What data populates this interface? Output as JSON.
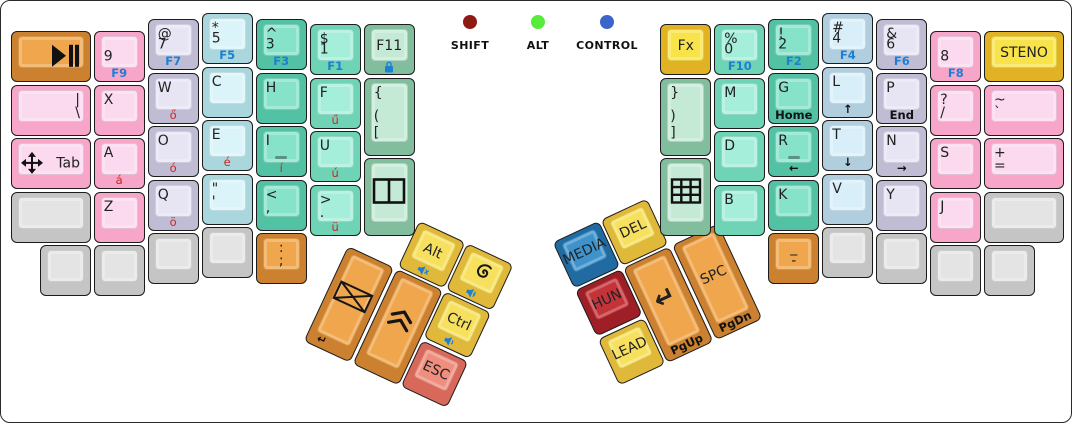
{
  "palette": {
    "canvas_bg": "#ffffff",
    "case_border": "#2a2a2a",
    "legend_blue": "#1b7fd4",
    "legend_red": "#cf2424",
    "colors": {
      "orange": {
        "base": "#cc8130",
        "face": "#efa64d"
      },
      "pink": {
        "base": "#f7a5c8",
        "face": "#fbd9ee"
      },
      "lavender": {
        "base": "#bfbcd3",
        "face": "#e7e5f4"
      },
      "cyan": {
        "base": "#aad7de",
        "face": "#daf4f9"
      },
      "teal": {
        "base": "#53c1a4",
        "face": "#86e3c9"
      },
      "green": {
        "base": "#6fd3b6",
        "face": "#a4eeda"
      },
      "sage": {
        "base": "#82bd9d",
        "face": "#c4ead5"
      },
      "lightblue": {
        "base": "#b1cede",
        "face": "#d8effa"
      },
      "yellow": {
        "base": "#e0b224",
        "face": "#f9e34a"
      },
      "yellowsoft": {
        "base": "#e0b93a",
        "face": "#f7e05e"
      },
      "blue": {
        "base": "#216ba3",
        "face": "#3f93cd"
      },
      "red": {
        "base": "#9e2026",
        "face": "#c43338"
      },
      "salmon": {
        "base": "#d7685a",
        "face": "#ef8e7e"
      },
      "gray": {
        "base": "#c5c5c5",
        "face": "#e4e4e4"
      }
    }
  },
  "indicators": [
    {
      "label": "SHIFT",
      "color": "#8e1a12",
      "cx": 469
    },
    {
      "label": "ALT",
      "color": "#57ec3a",
      "cx": 537
    },
    {
      "label": "CONTROL",
      "color": "#3b65cb",
      "cx": 606
    }
  ],
  "clusters": {
    "lt": {
      "x": 347,
      "y": 245,
      "angle": 25
    },
    "rt": {
      "x": 622,
      "y": 267,
      "angle": -25
    }
  },
  "keys": [
    {
      "name": "play-pause",
      "x": 10,
      "y": 30,
      "w": 80,
      "h": 51,
      "color": "orange",
      "icon_face": "play-pause-icon",
      "icon_pos": "ic-right",
      "legends": {}
    },
    {
      "name": "pipe-backslash",
      "x": 10,
      "y": 83.5,
      "w": 80,
      "h": 51,
      "color": "pink",
      "legends": {
        "tr": "|",
        "br": "\\"
      }
    },
    {
      "name": "tab",
      "x": 10,
      "y": 137,
      "w": 80,
      "h": 51,
      "color": "pink",
      "icon_face": "move-icon",
      "icon_pos": "ic-left",
      "legends": {
        "mr": "Tab"
      }
    },
    {
      "name": "blank-l1",
      "x": 10,
      "y": 190.5,
      "w": 80,
      "h": 51,
      "color": "gray",
      "legends": {}
    },
    {
      "name": "blank-l2",
      "x": 39,
      "y": 244,
      "w": 51,
      "h": 51,
      "color": "gray",
      "legends": {}
    },
    {
      "name": "9",
      "x": 92.7,
      "y": 30,
      "w": 51,
      "h": 51,
      "color": "pink",
      "legends": {
        "ml": "9",
        "front": "F9"
      },
      "front_color": "blue"
    },
    {
      "name": "x",
      "x": 92.7,
      "y": 83.5,
      "w": 51,
      "h": 51,
      "color": "pink",
      "legends": {
        "tl": "X"
      }
    },
    {
      "name": "a",
      "x": 92.7,
      "y": 137,
      "w": 51,
      "h": 51,
      "color": "pink",
      "legends": {
        "tl": "A",
        "front": "á"
      },
      "front_color": "red"
    },
    {
      "name": "z",
      "x": 92.7,
      "y": 190.5,
      "w": 51,
      "h": 51,
      "color": "pink",
      "legends": {
        "tl": "Z"
      }
    },
    {
      "name": "blank-l3",
      "x": 92.7,
      "y": 244,
      "w": 51,
      "h": 51,
      "color": "gray",
      "legends": {}
    },
    {
      "name": "7",
      "x": 146.7,
      "y": 18,
      "w": 51,
      "h": 51,
      "color": "lavender",
      "legends": {
        "tl": "@",
        "ml": "7",
        "front": "F7"
      },
      "front_color": "blue"
    },
    {
      "name": "w",
      "x": 146.7,
      "y": 71.5,
      "w": 51,
      "h": 51,
      "color": "lavender",
      "legends": {
        "tl": "W",
        "front": "ő"
      },
      "front_color": "red"
    },
    {
      "name": "o",
      "x": 146.7,
      "y": 125,
      "w": 51,
      "h": 51,
      "color": "lavender",
      "legends": {
        "tl": "O",
        "front": "ó"
      },
      "front_color": "red"
    },
    {
      "name": "q",
      "x": 146.7,
      "y": 178.5,
      "w": 51,
      "h": 51,
      "color": "lavender",
      "legends": {
        "tl": "Q",
        "front": "ö"
      },
      "front_color": "red"
    },
    {
      "name": "blank-l4",
      "x": 146.7,
      "y": 232,
      "w": 51,
      "h": 51,
      "color": "gray",
      "legends": {}
    },
    {
      "name": "5",
      "x": 200.7,
      "y": 12,
      "w": 51,
      "h": 51,
      "color": "cyan",
      "legends": {
        "tl": "*",
        "ml": "5",
        "front": "F5"
      },
      "front_color": "blue"
    },
    {
      "name": "c",
      "x": 200.7,
      "y": 65.5,
      "w": 51,
      "h": 51,
      "color": "cyan",
      "legends": {
        "tl": "C"
      }
    },
    {
      "name": "e",
      "x": 200.7,
      "y": 119,
      "w": 51,
      "h": 51,
      "color": "cyan",
      "legends": {
        "tl": "E",
        "front": "é"
      },
      "front_color": "red"
    },
    {
      "name": "quote-apostrophe",
      "x": 200.7,
      "y": 172.5,
      "w": 51,
      "h": 51,
      "color": "cyan",
      "legends": {
        "tl": "\"",
        "bl": "'"
      }
    },
    {
      "name": "blank-l5",
      "x": 200.7,
      "y": 226,
      "w": 51,
      "h": 51,
      "color": "gray",
      "legends": {}
    },
    {
      "name": "3",
      "x": 254.7,
      "y": 18,
      "w": 51,
      "h": 51,
      "color": "teal",
      "legends": {
        "tl": "^",
        "ml": "3",
        "front": "F3"
      },
      "front_color": "blue"
    },
    {
      "name": "h",
      "x": 254.7,
      "y": 71.5,
      "w": 51,
      "h": 51,
      "color": "teal",
      "legends": {
        "tl": "H"
      }
    },
    {
      "name": "i",
      "x": 254.7,
      "y": 125,
      "w": 51,
      "h": 51,
      "color": "teal",
      "homing": true,
      "legends": {
        "tl": "I",
        "front": "í"
      },
      "front_color": "red"
    },
    {
      "name": "less-comma",
      "x": 254.7,
      "y": 178.5,
      "w": 51,
      "h": 51,
      "color": "teal",
      "legends": {
        "tl": "<",
        "bl": ","
      }
    },
    {
      "name": "colon-semicolon",
      "x": 254.7,
      "y": 232,
      "w": 51,
      "h": 51,
      "color": "orange",
      "legends": {
        "tc": ":",
        "bc": ";"
      }
    },
    {
      "name": "1",
      "x": 308.7,
      "y": 23,
      "w": 51,
      "h": 51,
      "color": "green",
      "legends": {
        "tl": "$",
        "ml": "1",
        "front": "F1"
      },
      "front_color": "blue"
    },
    {
      "name": "f",
      "x": 308.7,
      "y": 76.5,
      "w": 51,
      "h": 51,
      "color": "green",
      "legends": {
        "tl": "F",
        "front": "ű"
      },
      "front_color": "red"
    },
    {
      "name": "u",
      "x": 308.7,
      "y": 130,
      "w": 51,
      "h": 51,
      "color": "green",
      "legends": {
        "tl": "U",
        "front": "ú"
      },
      "front_color": "red"
    },
    {
      "name": "greater-period",
      "x": 308.7,
      "y": 183.5,
      "w": 51,
      "h": 51,
      "color": "green",
      "legends": {
        "tl": ">",
        "bl": ".",
        "front": "ü"
      },
      "front_color": "red"
    },
    {
      "name": "f11",
      "x": 362.7,
      "y": 23,
      "w": 51,
      "h": 51,
      "color": "sage",
      "legends": {
        "ce": "F11"
      },
      "icon_front": "lock-icon"
    },
    {
      "name": "open-brackets",
      "x": 362.7,
      "y": 76.5,
      "w": 51,
      "h": 78.5,
      "color": "sage",
      "legends": {
        "tl": "{",
        "ml": "(",
        "bl": "["
      }
    },
    {
      "name": "split-window",
      "x": 362.7,
      "y": 156.5,
      "w": 51,
      "h": 78.5,
      "color": "sage",
      "icon_face": "split-window-icon",
      "icon_pos": "ic-ce",
      "legends": {}
    },
    {
      "name": "fx",
      "x": 659.3,
      "y": 23,
      "w": 51,
      "h": 51,
      "color": "yellow",
      "legends": {
        "ce": "Fx"
      }
    },
    {
      "name": "close-brackets",
      "x": 659.3,
      "y": 76.5,
      "w": 51,
      "h": 78.5,
      "color": "sage",
      "legends": {
        "tl": "}",
        "ml": ")",
        "bl": "]"
      }
    },
    {
      "name": "numpad",
      "x": 659.3,
      "y": 156.5,
      "w": 51,
      "h": 78.5,
      "color": "sage",
      "icon_face": "grid-icon",
      "icon_pos": "ic-ce",
      "legends": {}
    },
    {
      "name": "0",
      "x": 713.3,
      "y": 23,
      "w": 51,
      "h": 51,
      "color": "green",
      "legends": {
        "tl": "%",
        "ml": "0",
        "front": "F10"
      },
      "front_color": "blue"
    },
    {
      "name": "m",
      "x": 713.3,
      "y": 76.5,
      "w": 51,
      "h": 51,
      "color": "green",
      "legends": {
        "tl": "M"
      }
    },
    {
      "name": "d",
      "x": 713.3,
      "y": 130,
      "w": 51,
      "h": 51,
      "color": "green",
      "legends": {
        "tl": "D"
      }
    },
    {
      "name": "b",
      "x": 713.3,
      "y": 183.5,
      "w": 51,
      "h": 51,
      "color": "green",
      "legends": {
        "tl": "B"
      }
    },
    {
      "name": "2",
      "x": 767.3,
      "y": 18,
      "w": 51,
      "h": 51,
      "color": "teal",
      "legends": {
        "tl": "!",
        "ml": "2",
        "front": "F2"
      },
      "front_color": "blue"
    },
    {
      "name": "g",
      "x": 767.3,
      "y": 71.5,
      "w": 51,
      "h": 51,
      "color": "teal",
      "legends": {
        "tl": "G",
        "front": "Home"
      },
      "front_color": "black"
    },
    {
      "name": "r",
      "x": 767.3,
      "y": 125,
      "w": 51,
      "h": 51,
      "color": "teal",
      "homing": true,
      "legends": {
        "tl": "R",
        "front": "←"
      },
      "front_color": "black"
    },
    {
      "name": "k",
      "x": 767.3,
      "y": 178.5,
      "w": 51,
      "h": 51,
      "color": "teal",
      "legends": {
        "tl": "K"
      }
    },
    {
      "name": "underscore-dash",
      "x": 767.3,
      "y": 232,
      "w": 51,
      "h": 51,
      "color": "orange",
      "legends": {
        "tc": "_",
        "bc": "-"
      }
    },
    {
      "name": "4",
      "x": 821.3,
      "y": 12,
      "w": 51,
      "h": 51,
      "color": "lightblue",
      "legends": {
        "tl": "#",
        "ml": "4",
        "front": "F4"
      },
      "front_color": "blue"
    },
    {
      "name": "l",
      "x": 821.3,
      "y": 65.5,
      "w": 51,
      "h": 51,
      "color": "lightblue",
      "legends": {
        "tl": "L",
        "front": "↑"
      },
      "front_color": "black"
    },
    {
      "name": "t",
      "x": 821.3,
      "y": 119,
      "w": 51,
      "h": 51,
      "color": "lightblue",
      "legends": {
        "tl": "T",
        "front": "↓"
      },
      "front_color": "black"
    },
    {
      "name": "v",
      "x": 821.3,
      "y": 172.5,
      "w": 51,
      "h": 51,
      "color": "lightblue",
      "legends": {
        "tl": "V"
      }
    },
    {
      "name": "blank-r1",
      "x": 821.3,
      "y": 226,
      "w": 51,
      "h": 51,
      "color": "gray",
      "legends": {}
    },
    {
      "name": "6",
      "x": 875.3,
      "y": 18,
      "w": 51,
      "h": 51,
      "color": "lavender",
      "legends": {
        "tl": "&",
        "ml": "6",
        "front": "F6"
      },
      "front_color": "blue"
    },
    {
      "name": "p",
      "x": 875.3,
      "y": 71.5,
      "w": 51,
      "h": 51,
      "color": "lavender",
      "legends": {
        "tl": "P",
        "front": "End"
      },
      "front_color": "black"
    },
    {
      "name": "n",
      "x": 875.3,
      "y": 125,
      "w": 51,
      "h": 51,
      "color": "lavender",
      "legends": {
        "tl": "N",
        "front": "→"
      },
      "front_color": "black"
    },
    {
      "name": "y",
      "x": 875.3,
      "y": 178.5,
      "w": 51,
      "h": 51,
      "color": "lavender",
      "legends": {
        "tl": "Y"
      }
    },
    {
      "name": "blank-r2",
      "x": 875.3,
      "y": 232,
      "w": 51,
      "h": 51,
      "color": "gray",
      "legends": {}
    },
    {
      "name": "8",
      "x": 929.3,
      "y": 30,
      "w": 51,
      "h": 51,
      "color": "pink",
      "legends": {
        "ml": "8",
        "front": "F8"
      },
      "front_color": "blue"
    },
    {
      "name": "question-slash",
      "x": 929.3,
      "y": 83.5,
      "w": 51,
      "h": 51,
      "color": "pink",
      "legends": {
        "tl": "?",
        "bl": "/"
      }
    },
    {
      "name": "s",
      "x": 929.3,
      "y": 137,
      "w": 51,
      "h": 51,
      "color": "pink",
      "legends": {
        "tl": "S"
      }
    },
    {
      "name": "j",
      "x": 929.3,
      "y": 190.5,
      "w": 51,
      "h": 51,
      "color": "pink",
      "legends": {
        "tl": "J"
      }
    },
    {
      "name": "blank-r3",
      "x": 929.3,
      "y": 244,
      "w": 51,
      "h": 51,
      "color": "gray",
      "legends": {}
    },
    {
      "name": "steno",
      "x": 983,
      "y": 30,
      "w": 80,
      "h": 51,
      "color": "yellow",
      "legends": {
        "ce": "STENO"
      }
    },
    {
      "name": "tilde-backtick",
      "x": 983,
      "y": 83.5,
      "w": 80,
      "h": 51,
      "color": "pink",
      "legends": {
        "tl": "~",
        "bl": "`"
      }
    },
    {
      "name": "plus-equals",
      "x": 983,
      "y": 137,
      "w": 80,
      "h": 51,
      "color": "pink",
      "legends": {
        "tl": "+",
        "bl": "="
      }
    },
    {
      "name": "blank-r4",
      "x": 983,
      "y": 190.5,
      "w": 80,
      "h": 51,
      "color": "gray",
      "legends": {}
    },
    {
      "name": "blank-r5",
      "x": 983,
      "y": 244,
      "w": 51,
      "h": 51,
      "color": "gray",
      "legends": {}
    },
    {
      "name": "mail",
      "cluster": "lt",
      "x": 0,
      "y": 0,
      "w": 51,
      "h": 105,
      "color": "orange",
      "icon_face": "envelope-icon",
      "icon_pos": "ic-ce",
      "legends": {
        "front": "↵"
      },
      "front_color": "black"
    },
    {
      "name": "double-chevron-up",
      "cluster": "lt",
      "x": 53.5,
      "y": 0,
      "w": 51,
      "h": 105,
      "color": "orange",
      "icon_face": "chevron-up-icon",
      "icon_pos": "ic-ce",
      "legends": {}
    },
    {
      "name": "alt",
      "cluster": "lt",
      "x": 53.5,
      "y": -53.5,
      "w": 51,
      "h": 51,
      "color": "yellowsoft",
      "legends": {
        "ce": "Alt"
      },
      "icon_front": "mute-icon"
    },
    {
      "name": "debian",
      "cluster": "lt",
      "x": 107,
      "y": -53.5,
      "w": 51,
      "h": 51,
      "color": "yellowsoft",
      "icon_face": "spiral-icon",
      "icon_pos": "ic-ce",
      "legends": {},
      "icon_front": "volume-up-icon"
    },
    {
      "name": "ctrl",
      "cluster": "lt",
      "x": 107,
      "y": 0,
      "w": 51,
      "h": 51,
      "color": "yellowsoft",
      "legends": {
        "ce": "Ctrl"
      },
      "icon_front": "volume-down-icon"
    },
    {
      "name": "esc",
      "cluster": "lt",
      "x": 107,
      "y": 53.5,
      "w": 51,
      "h": 51,
      "color": "salmon",
      "legends": {
        "ce": "ESC"
      }
    },
    {
      "name": "enter",
      "cluster": "rt",
      "x": 0,
      "y": 0,
      "w": 51,
      "h": 105,
      "color": "orange",
      "big_center": true,
      "legends": {
        "ce": "↵",
        "front": "PgUp"
      },
      "front_color": "black"
    },
    {
      "name": "space",
      "cluster": "rt",
      "x": 53.5,
      "y": 0,
      "w": 51,
      "h": 105,
      "color": "orange",
      "legends": {
        "ce": "SPC",
        "front": "PgDn"
      },
      "front_color": "black"
    },
    {
      "name": "media",
      "cluster": "rt",
      "x": -53.5,
      "y": -53.5,
      "w": 51,
      "h": 51,
      "color": "blue",
      "legends": {
        "ce": "MEDIA"
      }
    },
    {
      "name": "del",
      "cluster": "rt",
      "x": 0,
      "y": -53.5,
      "w": 51,
      "h": 51,
      "color": "yellowsoft",
      "legends": {
        "ce": "DEL"
      }
    },
    {
      "name": "hun",
      "cluster": "rt",
      "x": -53.5,
      "y": 0,
      "w": 51,
      "h": 51,
      "color": "red",
      "legends": {
        "ce": "HUN"
      }
    },
    {
      "name": "lead",
      "cluster": "rt",
      "x": -53.5,
      "y": 53.5,
      "w": 51,
      "h": 51,
      "color": "yellowsoft",
      "legends": {
        "ce": "LEAD"
      }
    }
  ]
}
